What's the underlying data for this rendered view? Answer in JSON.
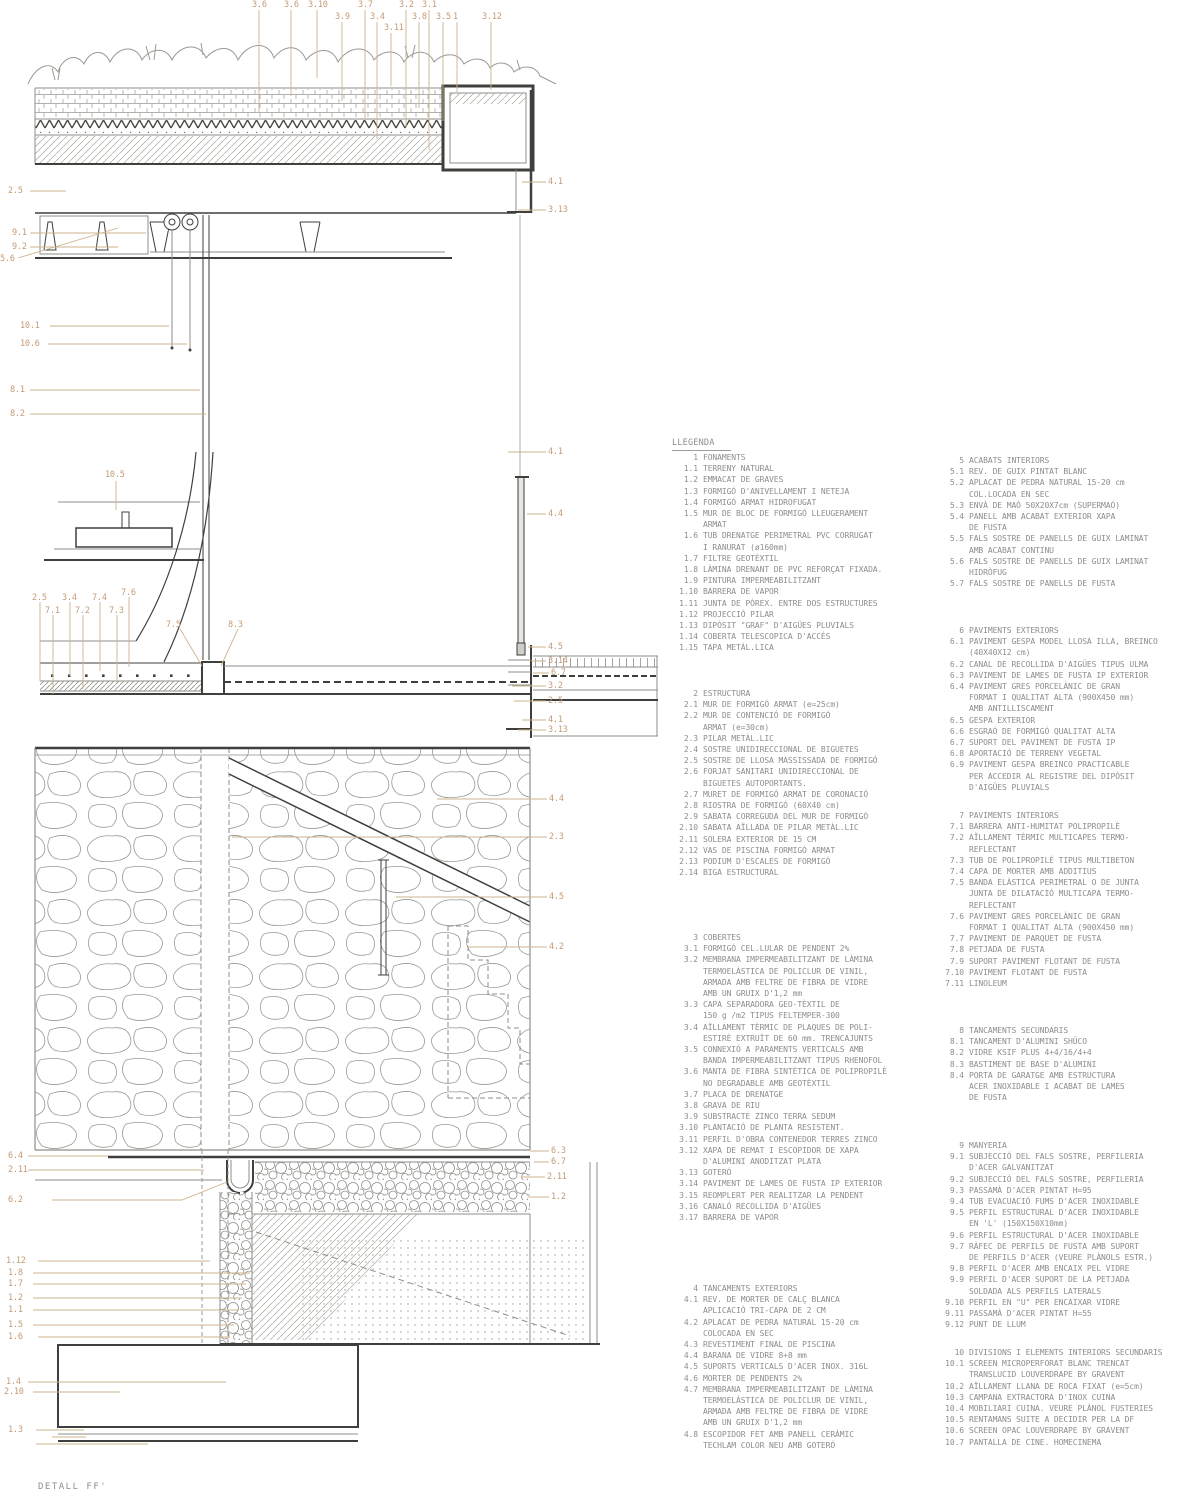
{
  "colors": {
    "callout": "#c49a76",
    "leader": "#cdb48c",
    "legend": "#8d8d8d",
    "line_dark": "#3f3f3c",
    "line_mid": "#8e8e89",
    "line_light": "#aeaea8",
    "bg": "#ffffff"
  },
  "drawing": {
    "title": "DETALL FF'",
    "callouts": [
      {
        "label": "3.6",
        "x": 252,
        "y": 1
      },
      {
        "label": "3.6",
        "x": 284,
        "y": 1
      },
      {
        "label": "3.10",
        "x": 308,
        "y": 1
      },
      {
        "label": "3.7",
        "x": 358,
        "y": 1
      },
      {
        "label": "3.2",
        "x": 399,
        "y": 1
      },
      {
        "label": "3.1",
        "x": 422,
        "y": 1
      },
      {
        "label": "3.9",
        "x": 335,
        "y": 13
      },
      {
        "label": "3.4",
        "x": 370,
        "y": 13
      },
      {
        "label": "3.8",
        "x": 412,
        "y": 13
      },
      {
        "label": "3.5",
        "x": 436,
        "y": 13
      },
      {
        "label": "1",
        "x": 453,
        "y": 13
      },
      {
        "label": "3.12",
        "x": 482,
        "y": 13
      },
      {
        "label": "3.11",
        "x": 384,
        "y": 24
      },
      {
        "label": "2.5",
        "x": 8,
        "y": 187
      },
      {
        "label": "9.1",
        "x": 12,
        "y": 229
      },
      {
        "label": "9.2",
        "x": 12,
        "y": 243
      },
      {
        "label": "5.6",
        "x": 0,
        "y": 255
      },
      {
        "label": "10.1",
        "x": 20,
        "y": 322
      },
      {
        "label": "10.6",
        "x": 20,
        "y": 340
      },
      {
        "label": "8.1",
        "x": 10,
        "y": 386
      },
      {
        "label": "8.2",
        "x": 10,
        "y": 410
      },
      {
        "label": "10.5",
        "x": 105,
        "y": 471
      },
      {
        "label": "2.5",
        "x": 32,
        "y": 594
      },
      {
        "label": "3.4",
        "x": 62,
        "y": 594
      },
      {
        "label": "7.4",
        "x": 92,
        "y": 594
      },
      {
        "label": "7.6",
        "x": 121,
        "y": 589
      },
      {
        "label": "7.1",
        "x": 45,
        "y": 607
      },
      {
        "label": "7.2",
        "x": 75,
        "y": 607
      },
      {
        "label": "7.3",
        "x": 109,
        "y": 607
      },
      {
        "label": "7.5",
        "x": 166,
        "y": 621
      },
      {
        "label": "8.3",
        "x": 228,
        "y": 621
      },
      {
        "label": "4.1",
        "x": 548,
        "y": 178
      },
      {
        "label": "3.13",
        "x": 548,
        "y": 206
      },
      {
        "label": "4.1",
        "x": 548,
        "y": 448
      },
      {
        "label": "4.4",
        "x": 548,
        "y": 510
      },
      {
        "label": "4.5",
        "x": 548,
        "y": 643
      },
      {
        "label": "3.14",
        "x": 548,
        "y": 657
      },
      {
        "label": "6.7",
        "x": 551,
        "y": 669
      },
      {
        "label": "3.2",
        "x": 548,
        "y": 682
      },
      {
        "label": "2.5",
        "x": 548,
        "y": 697
      },
      {
        "label": "4.1",
        "x": 548,
        "y": 716
      },
      {
        "label": "3.13",
        "x": 548,
        "y": 726
      },
      {
        "label": "4.4",
        "x": 549,
        "y": 795
      },
      {
        "label": "2.3",
        "x": 549,
        "y": 833
      },
      {
        "label": "4.5",
        "x": 549,
        "y": 893
      },
      {
        "label": "4.2",
        "x": 549,
        "y": 943
      },
      {
        "label": "6.3",
        "x": 551,
        "y": 1147
      },
      {
        "label": "6.7",
        "x": 551,
        "y": 1158
      },
      {
        "label": "2.11",
        "x": 547,
        "y": 1173
      },
      {
        "label": "1.2",
        "x": 551,
        "y": 1193
      },
      {
        "label": "6.4",
        "x": 8,
        "y": 1152
      },
      {
        "label": "2.11",
        "x": 8,
        "y": 1166
      },
      {
        "label": "6.2",
        "x": 8,
        "y": 1196
      },
      {
        "label": "1.12",
        "x": 6,
        "y": 1257
      },
      {
        "label": "1.8",
        "x": 8,
        "y": 1269
      },
      {
        "label": "1.7",
        "x": 8,
        "y": 1280
      },
      {
        "label": "1.2",
        "x": 8,
        "y": 1294
      },
      {
        "label": "1.1",
        "x": 8,
        "y": 1306
      },
      {
        "label": "1.5",
        "x": 8,
        "y": 1321
      },
      {
        "label": "1.6",
        "x": 8,
        "y": 1333
      },
      {
        "label": "1.4",
        "x": 6,
        "y": 1378
      },
      {
        "label": "2.10",
        "x": 4,
        "y": 1388
      },
      {
        "label": "1.3",
        "x": 8,
        "y": 1426
      }
    ]
  },
  "legend": {
    "title": "LLEGENDA",
    "sections": [
      {
        "num": "1",
        "title": "FONAMENTS",
        "items": [
          {
            "num": "1.1",
            "text": "TERRENY NATURAL"
          },
          {
            "num": "1.2",
            "text": "EMMACAT DE GRAVES"
          },
          {
            "num": "1.3",
            "text": "FORMIGÓ D'ANIVELLAMENT I NETEJA"
          },
          {
            "num": "1.4",
            "text": "FORMIGÓ ARMAT HIDROFUGAT"
          },
          {
            "num": "1.5",
            "text": "MUR DE BLOC DE FORMIGÓ LLEUGERAMENT\nARMAT"
          },
          {
            "num": "1.6",
            "text": "TUB DRENATGE PERIMETRAL PVC CORRUGAT\nI RANURAT (ø160mm)"
          },
          {
            "num": "1.7",
            "text": "FILTRE GEOTÈXTIL"
          },
          {
            "num": "1.8",
            "text": "LÀMINA DRENANT DE PVC REFORÇAT FIXADA."
          },
          {
            "num": "1.9",
            "text": "PINTURA IMPERMEABILITZANT"
          },
          {
            "num": "1.10",
            "text": "BARRERA DE VAPOR"
          },
          {
            "num": "1.11",
            "text": "JUNTA DE PÒREX. ENTRE DOS ESTRUCTURES"
          },
          {
            "num": "1.12",
            "text": "PROJECCIÓ PILAR"
          },
          {
            "num": "1.13",
            "text": "DIPÒSIT \"GRAF\" D'AIGÜES PLUVIALS"
          },
          {
            "num": "1.14",
            "text": "COBERTA TELESCOPICA D'ACCÉS"
          },
          {
            "num": "1.15",
            "text": "TAPA METÀL.LICA"
          }
        ]
      },
      {
        "num": "2",
        "title": "ESTRUCTURA",
        "items": [
          {
            "num": "2.1",
            "text": "MUR DE FORMIGÓ ARMAT (e=25cm)"
          },
          {
            "num": "2.2",
            "text": "MUR DE CONTENCIÓ DE FORMIGÓ\nARMAT (e=30cm)"
          },
          {
            "num": "2.3",
            "text": "PILAR METÀL.LIC"
          },
          {
            "num": "2.4",
            "text": "SOSTRE UNIDIRECCIONAL DE BIGUETES"
          },
          {
            "num": "2.5",
            "text": "SOSTRE DE LLOSA MASSISSADA DE FORMIGÓ"
          },
          {
            "num": "2.6",
            "text": "FORJAT SANITARI UNIDIRECCIONAL DE\nBIGUETES AUTOPORTANTS."
          },
          {
            "num": "2.7",
            "text": "MURET DE FORMIGÓ ARMAT DE CORONACIÓ"
          },
          {
            "num": "2.8",
            "text": "RIOSTRA DE FORMIGÓ (60X40 cm)"
          },
          {
            "num": "2.9",
            "text": "SABATA CORREGUDA DEL MUR DE FORMIGÓ"
          },
          {
            "num": "2.10",
            "text": "SABATA AÏLLADA DE PILAR METÀL.LIC"
          },
          {
            "num": "2.11",
            "text": "SOLERA EXTERIOR DE 15 CM"
          },
          {
            "num": "2.12",
            "text": "VAS DE PISCINA FORMIGÓ ARMAT"
          },
          {
            "num": "2.13",
            "text": "PODIUM D'ESCALES DE FORMIGÓ"
          },
          {
            "num": "2.14",
            "text": "BIGA ESTRUCTURAL"
          }
        ]
      },
      {
        "num": "3",
        "title": "COBERTES",
        "items": [
          {
            "num": "3.1",
            "text": "FORMIGÓ CEL.LULAR DE PENDENT 2%"
          },
          {
            "num": "3.2",
            "text": "MEMBRANA IMPERMEABILITZANT DE LÀMINA\nTERMOELÀSTICA DE POLICLUR DE VINIL,\nARMADA AMB FELTRE DE FIBRA DE VIDRE\nAMB UN GRUIX D'1,2 mm"
          },
          {
            "num": "3.3",
            "text": "CAPA SEPARADORA GEO-TÈXTIL DE\n150 g /m2 TIPUS FELTEMPER-300"
          },
          {
            "num": "3.4",
            "text": "AÏLLAMENT TÈRMIC DE PLAQUES DE POLI-\nESTIRÈ EXTRUÏT DE 60 mm. TRENCAJUNTS"
          },
          {
            "num": "3.5",
            "text": "CONNEXIÓ A PARAMENTS VERTICALS AMB\nBANDA IMPERMEABILITZANT TIPUS RHENOFOL"
          },
          {
            "num": "3.6",
            "text": "MANTA DE FIBRA SINTÈTICA DE POLIPROPILÈ\nNO DEGRADABLE AMB GEOTÈXTIL"
          },
          {
            "num": "3.7",
            "text": "PLACA DE DRENATGE"
          },
          {
            "num": "3.8",
            "text": "GRAVA DE RIU"
          },
          {
            "num": "3.9",
            "text": "SUBSTRACTE ZINCO TERRA SEDUM"
          },
          {
            "num": "3.10",
            "text": "PLANTACIÓ DE PLANTA RESISTENT."
          },
          {
            "num": "3.11",
            "text": "PERFIL D'OBRA CONTENEDOR TERRES ZINCO"
          },
          {
            "num": "3.12",
            "text": "XAPA DE REMAT I ESCOPIDOR DE XAPA\nD'ALUMINI ANODITZAT PLATA"
          },
          {
            "num": "3.13",
            "text": "GOTERÓ"
          },
          {
            "num": "3.14",
            "text": "PAVIMENT DE LAMES DE FUSTA IP EXTERIOR"
          },
          {
            "num": "3.15",
            "text": "REOMPLERT PER REALITZAR LA PENDENT"
          },
          {
            "num": "3.16",
            "text": "CANALÓ RECOLLIDA D'AIGÜES"
          },
          {
            "num": "3.17",
            "text": "BARRERA DE VAPOR"
          }
        ]
      },
      {
        "num": "4",
        "title": "TANCAMENTS EXTERIORS",
        "items": [
          {
            "num": "4.1",
            "text": "REV. DE MORTER DE CALÇ BLANCA\nAPLICACIÓ TRI-CAPA DE 2 CM"
          },
          {
            "num": "4.2",
            "text": "APLACAT DE PEDRA NATURAL 15-20 cm\nCOLOCADA EN SEC"
          },
          {
            "num": "4.3",
            "text": "REVESTIMENT FINAL DE PISCINA"
          },
          {
            "num": "4.4",
            "text": "BARANA DE VIDRE 8+8 mm"
          },
          {
            "num": "4.5",
            "text": "SUPORTS VERTICALS D'ACER INOX. 316L"
          },
          {
            "num": "4.6",
            "text": "MORTER DE PENDENTS 2%"
          },
          {
            "num": "4.7",
            "text": "MEMBRANA IMPERMEABILITZANT DE LÀMINA\nTERMOELÀSTICA DE POLICLUR DE VINIL,\nARMADA AMB FELTRE DE FIBRA DE VIDRE\nAMB UN GRUIX D'1,2 mm"
          },
          {
            "num": "4.8",
            "text": "ESCOPIDOR FET AMB PANELL CERÀMIC\nTECHLAM COLOR NEU AMB GOTERÓ"
          }
        ]
      },
      {
        "num": "5",
        "title": "ACABATS INTERIORS",
        "items": [
          {
            "num": "5.1",
            "text": "REV. DE GUIX PINTAT BLANC"
          },
          {
            "num": "5.2",
            "text": "APLACAT DE PEDRA NATURAL 15-20 cm\nCOL.LOCADA EN SEC"
          },
          {
            "num": "5.3",
            "text": "ENVÀ DE MAÓ 50X20X7cm (SUPERMAÓ)"
          },
          {
            "num": "5.4",
            "text": "PANELL AMB ACABAT EXTERIOR XAPA\nDE FUSTA"
          },
          {
            "num": "5.5",
            "text": "FALS SOSTRE DE PANELLS DE GUIX LAMINAT\nAMB ACABAT CONTINU"
          },
          {
            "num": "5.6",
            "text": "FALS SOSTRE DE PANELLS DE GUIX LAMINAT\nHIDRÒFUG"
          },
          {
            "num": "5.7",
            "text": "FALS SOSTRE DE PANELLS DE FUSTA"
          }
        ]
      },
      {
        "num": "6",
        "title": "PAVIMENTS EXTERIORS",
        "items": [
          {
            "num": "6.1",
            "text": "PAVIMENT GESPA MODEL LLOSA ILLA, BREINCO\n(40X40X12 cm)"
          },
          {
            "num": "6.2",
            "text": "CANAL DE RECOLLIDA D'AIGÜES TIPUS ULMA"
          },
          {
            "num": "6.3",
            "text": "PAVIMENT DE LAMES DE FUSTA IP EXTERIOR"
          },
          {
            "num": "6.4",
            "text": "PAVIMENT GRES PORCELÀNIC DE GRAN\nFORMAT I QUALITAT ALTA (900X450 mm)\nAMB ANTILLISCAMENT"
          },
          {
            "num": "6.5",
            "text": "GESPA EXTERIOR"
          },
          {
            "num": "6.6",
            "text": "ESGRAÓ DE FORMIGÓ QUALITAT ALTA"
          },
          {
            "num": "6.7",
            "text": "SUPORT DEL PAVIMENT DE FUSTA IP"
          },
          {
            "num": "6.8",
            "text": "APORTACIÓ DE TERRENY VEGETAL"
          },
          {
            "num": "6.9",
            "text": "PAVIMENT GESPA BREINCO PRACTICABLE\nPER ACCEDIR AL REGISTRE DEL DIPÒSIT\nD'AIGÜES PLUVIALS"
          }
        ]
      },
      {
        "num": "7",
        "title": "PAVIMENTS INTERIORS",
        "items": [
          {
            "num": "7.1",
            "text": "BARRERA ANTI-HUMITAT POLIPROPILÈ"
          },
          {
            "num": "7.2",
            "text": "AÏLLAMENT TÈRMIC MULTICAPES TERMO-\nREFLECTANT"
          },
          {
            "num": "7.3",
            "text": "TUB DE POLIPROPILÈ TIPUS MULTIBETON"
          },
          {
            "num": "7.4",
            "text": "CAPA DE MORTER AMB ADDITIUS"
          },
          {
            "num": "7.5",
            "text": "BANDA ELÀSTICA PERIMETRAL O DE JUNTA\nJUNTA DE DILATACIÓ MULTICAPA TERMO-\nREFLECTANT"
          },
          {
            "num": "7.6",
            "text": "PAVIMENT GRES PORCELÀNIC DE GRAN\nFORMAT I QUALITAT ALTA (900X450 mm)"
          },
          {
            "num": "7.7",
            "text": "PAVIMENT DE PARQUET DE FUSTA"
          },
          {
            "num": "7.8",
            "text": "PETJADA DE FUSTA"
          },
          {
            "num": "7.9",
            "text": "SUPORT PAVIMENT FLOTANT DE FUSTA"
          },
          {
            "num": "7.10",
            "text": "PAVIMENT FLOTANT DE FUSTA"
          },
          {
            "num": "7.11",
            "text": "LINOLEUM"
          }
        ]
      },
      {
        "num": "8",
        "title": "TANCAMENTS SECUNDARIS",
        "items": [
          {
            "num": "8.1",
            "text": "TANCAMENT D'ALUMINI SHÜCO"
          },
          {
            "num": "8.2",
            "text": "VIDRE KSIF PLUS 4+4/16/4+4"
          },
          {
            "num": "8.3",
            "text": "BASTIMENT DE BASE D'ALUMINI"
          },
          {
            "num": "8.4",
            "text": "PORTA DE GARATGE AMB ESTRUCTURA\nACER INOXIDABLE I ACABAT DE LAMES\nDE FUSTA"
          }
        ]
      },
      {
        "num": "9",
        "title": "MANYERIA",
        "items": [
          {
            "num": "9.1",
            "text": "SUBJECCIÓ DEL FALS SOSTRE, PERFILERIA\nD'ACER GALVANITZAT"
          },
          {
            "num": "9.2",
            "text": "SUBJECCIÓ DEL FALS SOSTRE, PERFILERIA"
          },
          {
            "num": "9.3",
            "text": "PASSAMÀ D'ACER PINTAT H=95"
          },
          {
            "num": "9.4",
            "text": "TUB EVACUACIÓ FUMS D'ACER INOXIDABLE"
          },
          {
            "num": "9.5",
            "text": "PERFIL ESTRUCTURAL D'ACER INOXIDABLE\nEN 'L' (150X150X10mm)"
          },
          {
            "num": "9.6",
            "text": "PERFIL ESTRUCTURAL D'ACER INOXIDABLE"
          },
          {
            "num": "9.7",
            "text": "RÀFEC DE PERFILS DE FUSTA AMB SUPORT\nDE PERFILS D'ACER (VEURE PLÀNOLS ESTR.)"
          },
          {
            "num": "9.8",
            "text": "PERFIL D'ACER AMB ENCAIX PEL VIDRE"
          },
          {
            "num": "9.9",
            "text": "PERFIL D'ACER SUPORT DE LA PETJADA\nSOLDADA ALS PERFILS LATERALS"
          },
          {
            "num": "9.10",
            "text": "PERFIL EN \"U\" PER ENCAIXAR VIDRE"
          },
          {
            "num": "9.11",
            "text": "PASSAMÀ D'ACER PINTAT H=55"
          },
          {
            "num": "9.12",
            "text": "PUNT DE LLUM"
          }
        ]
      },
      {
        "num": "10",
        "title": "DIVISIONS I ELEMENTS INTERIORS SECUNDARIS",
        "items": [
          {
            "num": "10.1",
            "text": "SCREEN MICROPERFORAT BLANC TRENCAT\nTRANSLUCID LOUVERDRAPE BY GRAVENT"
          },
          {
            "num": "10.2",
            "text": "AÏLLAMENT LLANA DE ROCA FIXAT (e=5cm)"
          },
          {
            "num": "10.3",
            "text": "CAMPANA EXTRACTORA D'INOX CUINA"
          },
          {
            "num": "10.4",
            "text": "MOBILIARI CUINA. VEURE PLÀNOL FUSTERIES"
          },
          {
            "num": "10.5",
            "text": "RENTAMANS SUITE A DECIDIR PER LA DF"
          },
          {
            "num": "10.6",
            "text": "SCREEN OPAC LOUVERDRAPE BY GRAVENT"
          },
          {
            "num": "10.7",
            "text": "PANTALLA DE CINE. HOMECINEMA"
          }
        ]
      }
    ]
  }
}
